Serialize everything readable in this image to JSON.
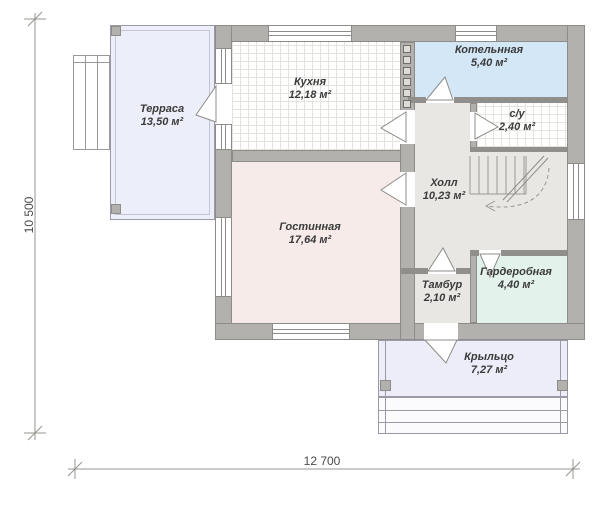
{
  "plan": {
    "title": "Floor plan — first floor",
    "rooms": [
      {
        "id": "terrace",
        "name": "Терраса",
        "area": "13,50 м²",
        "fill": "#eceef9"
      },
      {
        "id": "kitchen",
        "name": "Кухня",
        "area": "12,18 м²",
        "fill": "#ffffff"
      },
      {
        "id": "boiler",
        "name": "Котельнная",
        "area": "5,40 м²",
        "fill": "#d3e7f7"
      },
      {
        "id": "wc",
        "name": "с/у",
        "area": "2,40 м²",
        "fill": "#ffffff"
      },
      {
        "id": "hall",
        "name": "Холл",
        "area": "10,23 м²",
        "fill": "#e8e7e4"
      },
      {
        "id": "living",
        "name": "Гостинная",
        "area": "17,64 м²",
        "fill": "#f7ebea"
      },
      {
        "id": "wardrobe",
        "name": "Гардеробная",
        "area": "4,40 м²",
        "fill": "#e4f2ec"
      },
      {
        "id": "vestibule",
        "name": "Тамбур",
        "area": "2,10 м²",
        "fill": "#e8e7e4"
      },
      {
        "id": "porch",
        "name": "Крыльцо",
        "area": "7,27 м²",
        "fill": "#ecedf8"
      }
    ],
    "dimensions": {
      "height_label": "10 500",
      "width_label": "12 700"
    },
    "colors": {
      "wall": "#b3b1ae",
      "wall_edge": "#8d8c88",
      "text": "#3b3b3b",
      "dim_line": "#95948f"
    }
  }
}
